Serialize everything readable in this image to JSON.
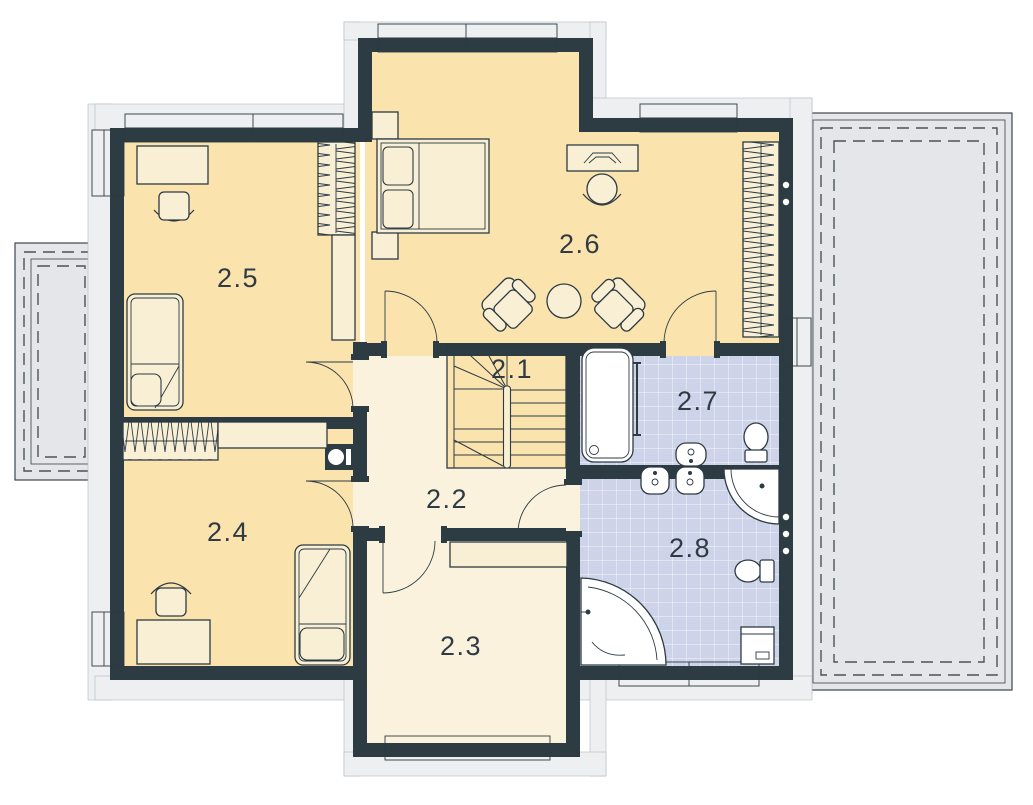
{
  "plan": {
    "title": "Upper floor plan",
    "rooms": {
      "r21": {
        "label": "2.1"
      },
      "r22": {
        "label": "2.2"
      },
      "r23": {
        "label": "2.3"
      },
      "r24": {
        "label": "2.4"
      },
      "r25": {
        "label": "2.5"
      },
      "r26": {
        "label": "2.6"
      },
      "r27": {
        "label": "2.7"
      },
      "r28": {
        "label": "2.8"
      }
    },
    "colors": {
      "wall": "#2d3b43",
      "bedroom_floor": "#fbe3ae",
      "hall_floor": "#fbf2dd",
      "bath_floor": "#cdd3e8",
      "furniture": "#f8efd4",
      "fixture": "#ffffff",
      "terrace": "#e4e6e9",
      "trim": "#edeff1",
      "window": "#ffffff",
      "label": "#2e3b45"
    }
  }
}
